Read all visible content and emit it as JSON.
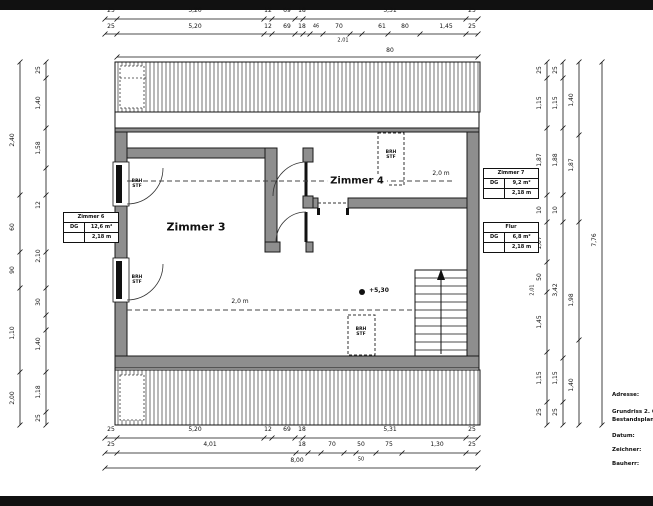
{
  "title_block": {
    "adresse": "Adresse:",
    "title": "Grundriss 2. OG",
    "subtitle": "Bestandsplan, M 1:50",
    "datum": "Datum:",
    "zeichner": "Zeichner:",
    "bauherr": "Bauherr:"
  },
  "rooms": {
    "zimmer3_label": "Zimmer 3",
    "zimmer4_label": "Zimmer 4"
  },
  "annotations": {
    "height_line_upper": "2,0 m",
    "height_line_lower": "2,0 m",
    "level_marker": "+5,30",
    "brh": "BRH\nSTF"
  },
  "room_tables": {
    "left": {
      "title": "Zimmer 6",
      "floor": "DG",
      "area": "12,6 m²",
      "height": "2,18 m"
    },
    "zimmer7": {
      "title": "Zimmer 7",
      "floor": "DG",
      "area": "9,2 m²",
      "height": "2,18 m"
    },
    "flur": {
      "title": "Flur",
      "floor": "DG",
      "area": "6,8 m²",
      "height": "2,18 m"
    }
  },
  "dims": {
    "top_row1": [
      "25",
      "5,20",
      "12",
      "69",
      "18",
      "5,31",
      "25"
    ],
    "top_row2": [
      "25",
      "5,20",
      "12",
      "69",
      "18",
      "46",
      "70",
      "61",
      "80",
      "1,45",
      "25"
    ],
    "top_row2_sub": "2,01",
    "top_band": "80",
    "bottom_row1": [
      "25",
      "5,20",
      "12",
      "69",
      "18",
      "5,31",
      "25"
    ],
    "bottom_row2": [
      "25",
      "4,01",
      "18",
      "70",
      "50",
      "75",
      "1,30",
      "25"
    ],
    "bottom_row2_sub": "50",
    "bottom_total": "8,00",
    "left_outer": [
      "2,40",
      "60",
      "90",
      "1,10",
      "2,00"
    ],
    "left_inner": [
      "25",
      "1,40",
      "1,58",
      "12",
      "2,10",
      "30",
      "1,40",
      "1,18",
      "25"
    ],
    "right_1": [
      "25",
      "1,15",
      "1,87",
      "10",
      "1,07",
      "50",
      "1,45",
      "1,15",
      "25"
    ],
    "right_1_sub": "2,01",
    "right_2": [
      "25",
      "1,15",
      "1,88",
      "10",
      "3,42",
      "1,15",
      "25"
    ],
    "right_3": [
      "1,40",
      "1,87",
      "1,98",
      "1,40"
    ],
    "right_total": "7,76"
  }
}
